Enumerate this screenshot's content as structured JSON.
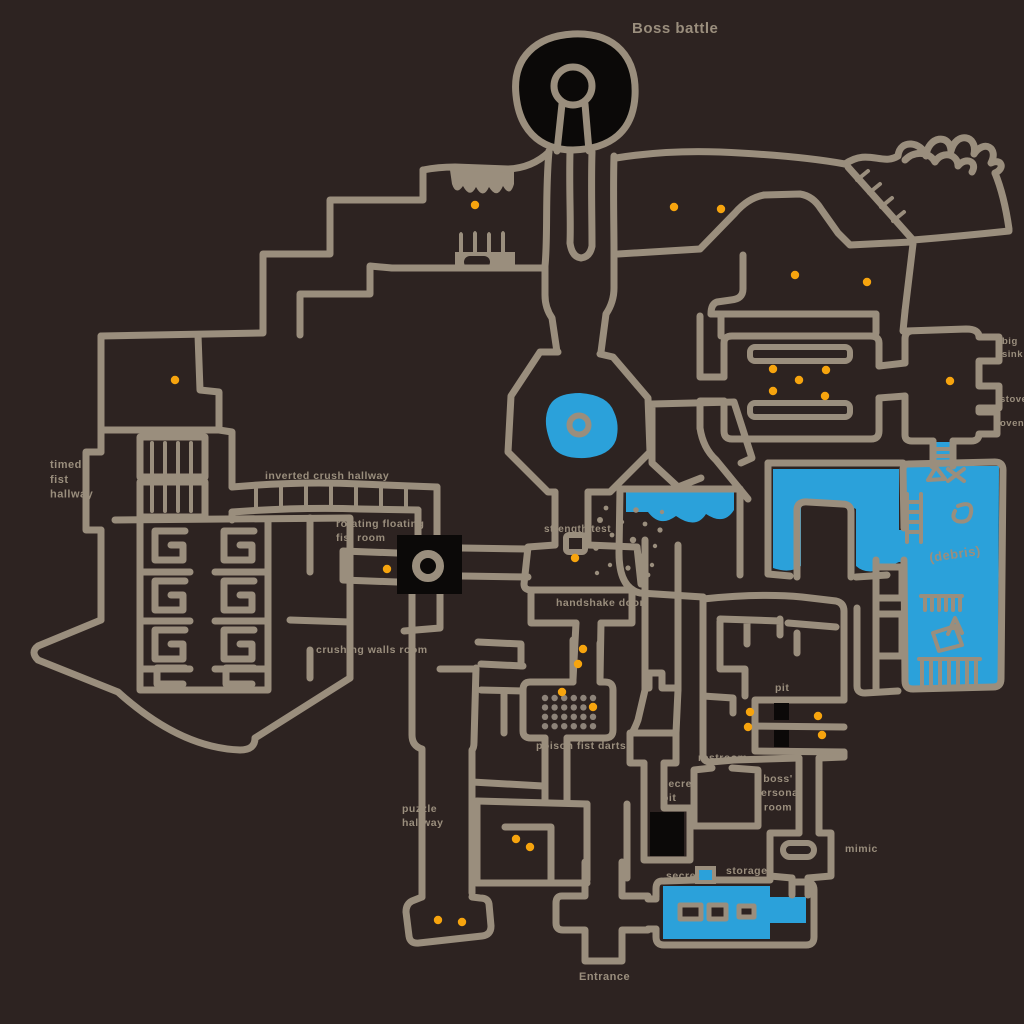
{
  "map": {
    "title": "Boss battle",
    "colors": {
      "background": "#2d2321",
      "wall": "#9a8e7d",
      "water": "#2ba1da",
      "pit_black": "#0b0908",
      "item_dot": "#f6a40e",
      "dart_dot": "#8d8379"
    },
    "labels": [
      {
        "name": "boss-battle",
        "text": "Boss battle",
        "x": 632,
        "y": 33,
        "size": 15
      },
      {
        "name": "timed-fist-hallway",
        "lines": [
          "timed",
          "fist",
          "hallway"
        ],
        "x": 50,
        "y": 468,
        "size": 11
      },
      {
        "name": "inverted-crush-hallway",
        "text": "inverted crush hallway",
        "x": 265,
        "y": 479,
        "size": 10.5
      },
      {
        "name": "rotating-floating-fist-room",
        "lines": [
          "rotating floating",
          "fist room"
        ],
        "x": 336,
        "y": 527,
        "size": 10.5
      },
      {
        "name": "crushing-walls-room",
        "text": "crushing walls room",
        "x": 316,
        "y": 653,
        "size": 10.5
      },
      {
        "name": "strength-test",
        "text": "strength test",
        "x": 544,
        "y": 532,
        "size": 10
      },
      {
        "name": "handshake-door",
        "text": "handshake door",
        "x": 556,
        "y": 606,
        "size": 10.5
      },
      {
        "name": "poison-fist-darts",
        "text": "poison fist darts",
        "x": 536,
        "y": 749,
        "size": 10.5
      },
      {
        "name": "puzzle-hallway",
        "lines": [
          "puzzle",
          "hallway"
        ],
        "x": 402,
        "y": 812,
        "size": 10.5
      },
      {
        "name": "restroom",
        "text": "restroom",
        "x": 698,
        "y": 761,
        "size": 10.5
      },
      {
        "name": "secret-pit",
        "lines": [
          "secret",
          "pit"
        ],
        "x": 662,
        "y": 787,
        "size": 10.5
      },
      {
        "name": "pit",
        "text": "pit",
        "x": 775,
        "y": 691,
        "size": 10.5
      },
      {
        "name": "boss-personal-room",
        "lines": [
          "boss'",
          "personal",
          "room"
        ],
        "x": 778,
        "y": 782,
        "size": 10.5,
        "align": "center"
      },
      {
        "name": "mimic",
        "text": "mimic",
        "x": 845,
        "y": 852,
        "size": 10.5
      },
      {
        "name": "storage",
        "text": "storage",
        "x": 726,
        "y": 874,
        "size": 10.5
      },
      {
        "name": "secret-storage",
        "text": "secret",
        "x": 666,
        "y": 879,
        "size": 10.5
      },
      {
        "name": "entrance",
        "text": "Entrance",
        "x": 579,
        "y": 980,
        "size": 11
      },
      {
        "name": "big-sink",
        "lines": [
          "big",
          "sink"
        ],
        "x": 1002,
        "y": 344,
        "size": 9.5
      },
      {
        "name": "stove",
        "text": "stove",
        "x": 1000,
        "y": 402,
        "size": 9.5
      },
      {
        "name": "oven",
        "text": "oven",
        "x": 1000,
        "y": 426,
        "size": 9.5
      },
      {
        "name": "debris",
        "text": "(debris)",
        "x": 930,
        "y": 562,
        "size": 13,
        "angle": -8
      }
    ],
    "item_dots": [
      [
        475,
        205
      ],
      [
        674,
        207
      ],
      [
        721,
        209
      ],
      [
        795,
        275
      ],
      [
        867,
        282
      ],
      [
        175,
        380
      ],
      [
        950,
        381
      ],
      [
        773,
        369
      ],
      [
        826,
        370
      ],
      [
        799,
        380
      ],
      [
        773,
        391
      ],
      [
        825,
        396
      ],
      [
        387,
        569
      ],
      [
        575,
        558
      ],
      [
        583,
        649
      ],
      [
        578,
        664
      ],
      [
        562,
        692
      ],
      [
        593,
        707
      ],
      [
        750,
        712
      ],
      [
        748,
        727
      ],
      [
        818,
        716
      ],
      [
        822,
        735
      ],
      [
        516,
        839
      ],
      [
        530,
        847
      ],
      [
        438,
        920
      ],
      [
        462,
        922
      ]
    ],
    "dart_grid": {
      "x0": 545,
      "y0": 698,
      "cols": 6,
      "rows": 4,
      "dx": 9.6,
      "dy": 9.4
    }
  }
}
